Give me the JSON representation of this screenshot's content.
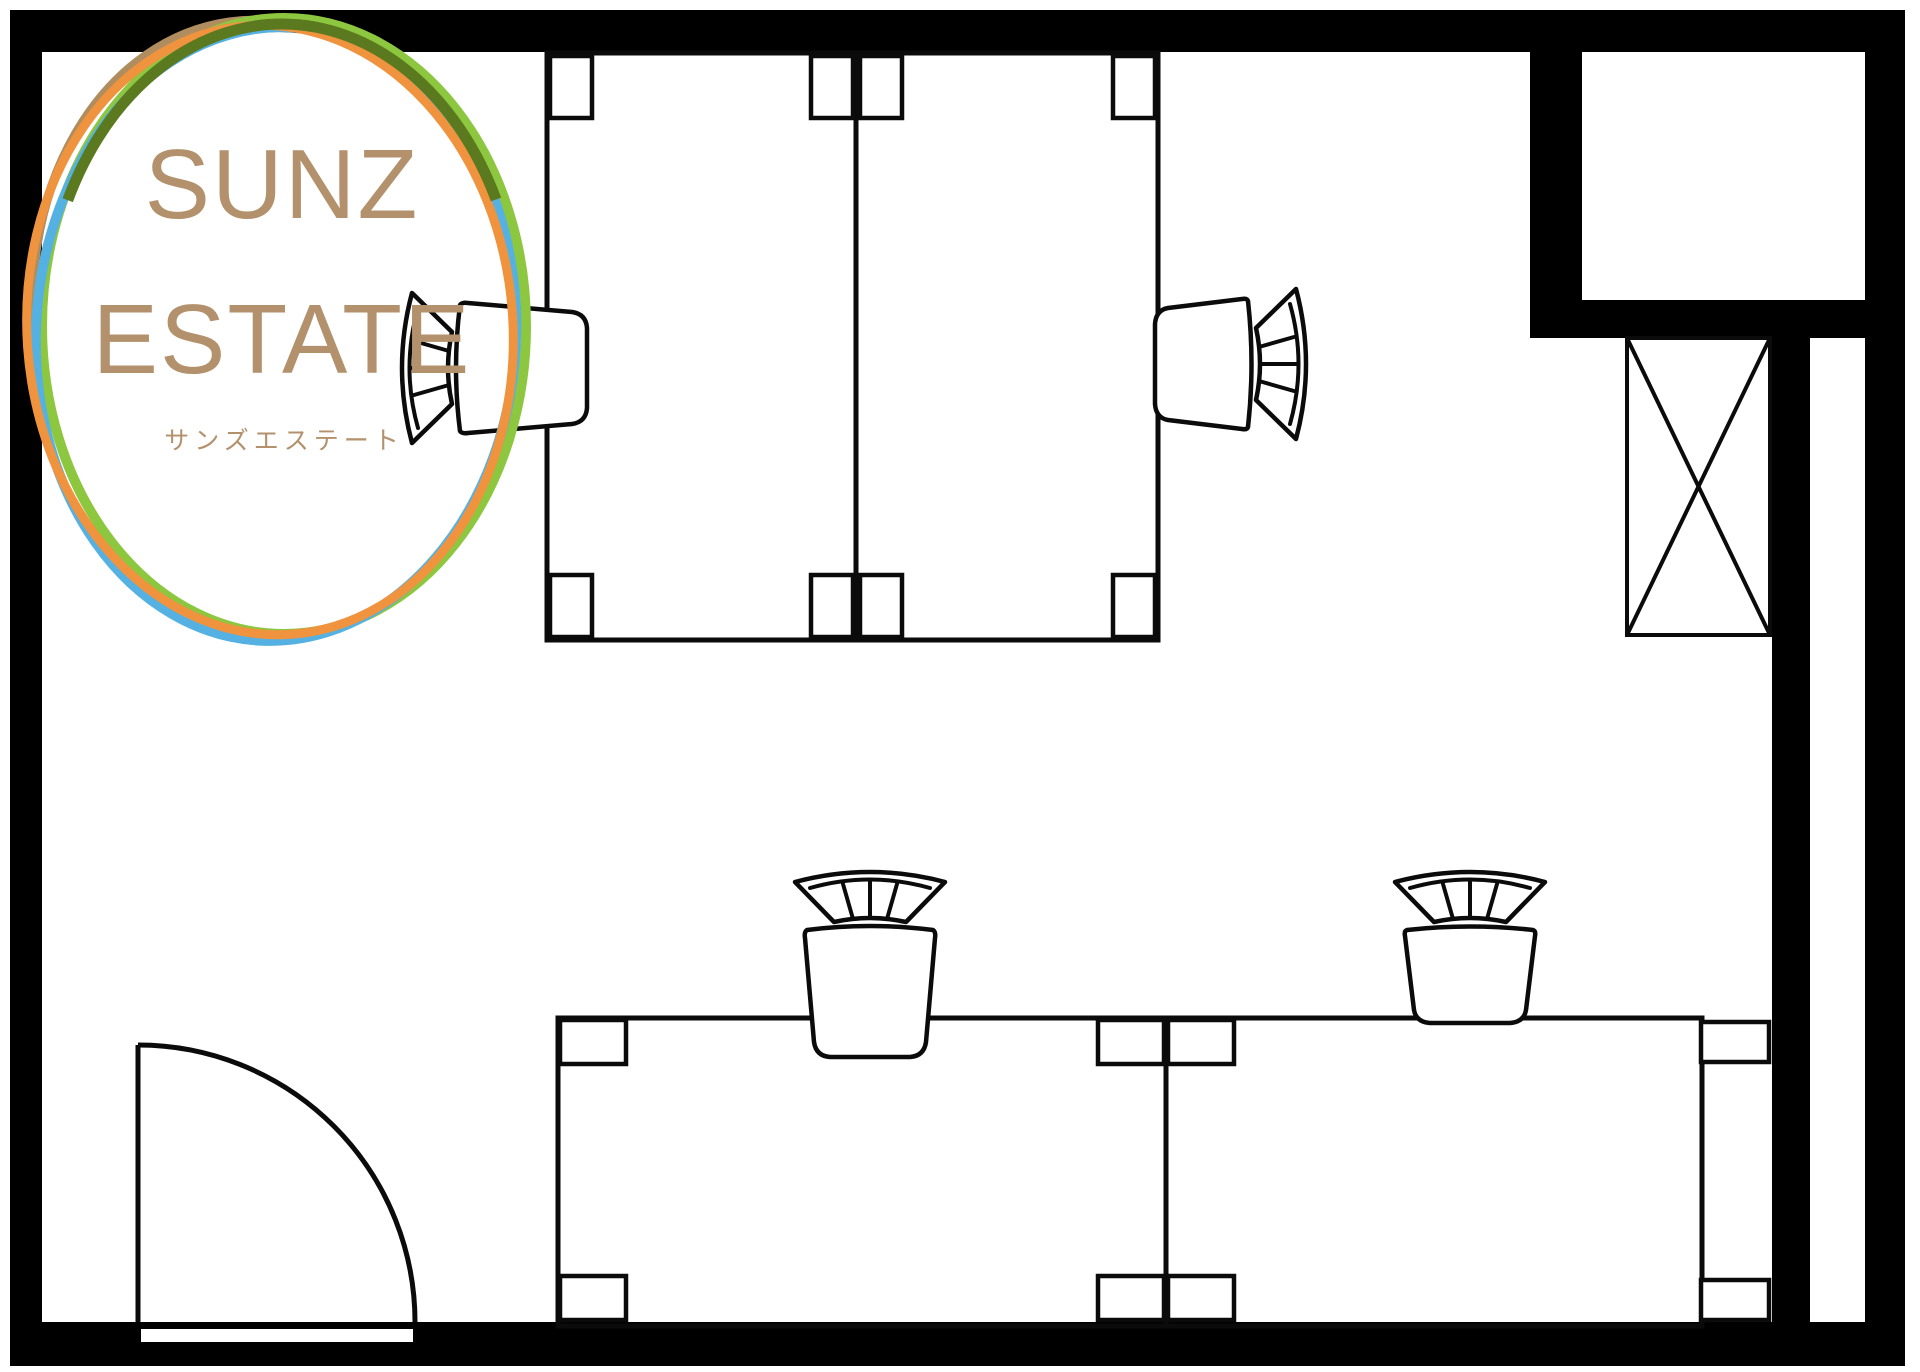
{
  "logo": {
    "line1": "SUNZ",
    "line2": "ESTATE",
    "subtitle": "サンズエステート",
    "text_color": "#b3916c",
    "circle_colors": {
      "tan": "#b08d5f",
      "green": "#8dc63f",
      "blue": "#55b1e2",
      "orange": "#f0933f",
      "olive": "#5b7a1f"
    }
  },
  "drawing": {
    "background": "#ffffff",
    "wall_color": "#000000",
    "line_color": "#0b0b0b"
  }
}
